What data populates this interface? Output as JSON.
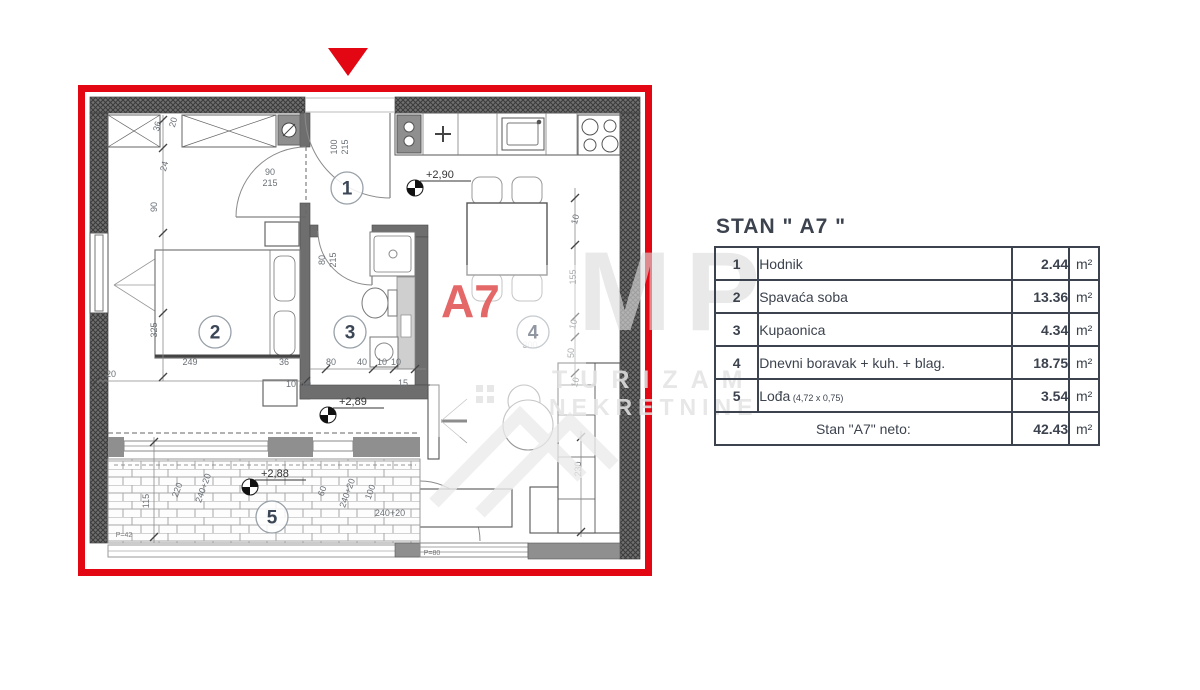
{
  "colors": {
    "accent_red": "#e30613",
    "wall_dark": "#6f6f6f",
    "text_dark": "#3c434e",
    "a7_red": "#e25c5c",
    "watermark": "#e3e3e3"
  },
  "watermark": {
    "letters": "MP",
    "line1": "TURIZAM",
    "line2": "NEKRETNINE"
  },
  "plan": {
    "a7_label": "A7",
    "room_numbers": [
      {
        "n": "1",
        "x": 269,
        "y": 103
      },
      {
        "n": "2",
        "x": 137,
        "y": 247
      },
      {
        "n": "3",
        "x": 272,
        "y": 247
      },
      {
        "n": "4",
        "x": 455,
        "y": 247
      },
      {
        "n": "5",
        "x": 194,
        "y": 432
      }
    ],
    "elevations": [
      {
        "t": "+2,90",
        "x": 337,
        "y": 103
      },
      {
        "t": "+2,89",
        "x": 250,
        "y": 330
      },
      {
        "t": "+2,88",
        "x": 172,
        "y": 402
      }
    ],
    "dim_labels": [
      {
        "t": "36",
        "x": 82,
        "y": 42,
        "r": -75
      },
      {
        "t": "20",
        "x": 98,
        "y": 38,
        "r": -75
      },
      {
        "t": "24",
        "x": 89,
        "y": 82,
        "r": -75
      },
      {
        "t": "90",
        "x": 79,
        "y": 122,
        "r": -90
      },
      {
        "t": "325",
        "x": 79,
        "y": 245,
        "r": -90
      },
      {
        "t": "100",
        "x": 259,
        "y": 62,
        "r": -90
      },
      {
        "t": "215",
        "x": 270,
        "y": 62,
        "r": -90
      },
      {
        "t": "90",
        "x": 192,
        "y": 90,
        "r": 0
      },
      {
        "t": "215",
        "x": 192,
        "y": 101,
        "r": 0
      },
      {
        "t": "80",
        "x": 247,
        "y": 175,
        "r": -90
      },
      {
        "t": "215",
        "x": 258,
        "y": 175,
        "r": -90
      },
      {
        "t": "249",
        "x": 112,
        "y": 280,
        "r": 0
      },
      {
        "t": "36",
        "x": 206,
        "y": 280,
        "r": 0
      },
      {
        "t": "20",
        "x": 33,
        "y": 292,
        "r": 0
      },
      {
        "t": "10",
        "x": 213,
        "y": 302,
        "r": 0
      },
      {
        "t": "10",
        "x": 228,
        "y": 302,
        "r": 0
      },
      {
        "t": "80",
        "x": 253,
        "y": 280,
        "r": 0
      },
      {
        "t": "40",
        "x": 284,
        "y": 280,
        "r": 0
      },
      {
        "t": "10",
        "x": 304,
        "y": 280,
        "r": 0
      },
      {
        "t": "10",
        "x": 318,
        "y": 280,
        "r": 0
      },
      {
        "t": "15",
        "x": 325,
        "y": 301,
        "r": 0
      },
      {
        "t": "10",
        "x": 500,
        "y": 135,
        "r": -75
      },
      {
        "t": "155",
        "x": 498,
        "y": 192,
        "r": -90
      },
      {
        "t": "10",
        "x": 498,
        "y": 240,
        "r": -75
      },
      {
        "t": "50",
        "x": 496,
        "y": 268,
        "r": -90
      },
      {
        "t": "300",
        "x": 452,
        "y": 263,
        "r": 0
      },
      {
        "t": "10",
        "x": 500,
        "y": 298,
        "r": -75
      },
      {
        "t": "230",
        "x": 503,
        "y": 384,
        "r": -90
      },
      {
        "t": "115",
        "x": 71,
        "y": 416,
        "r": -90
      },
      {
        "t": "220",
        "x": 102,
        "y": 406,
        "r": -70
      },
      {
        "t": "240+20",
        "x": 128,
        "y": 404,
        "r": -70
      },
      {
        "t": "60",
        "x": 247,
        "y": 407,
        "r": -70
      },
      {
        "t": "240+20",
        "x": 272,
        "y": 409,
        "r": -70
      },
      {
        "t": "100",
        "x": 295,
        "y": 408,
        "r": -70
      },
      {
        "t": "240+20",
        "x": 312,
        "y": 431,
        "r": 0
      }
    ],
    "area_labels": [
      {
        "t": "P=42",
        "x": 46,
        "y": 452
      },
      {
        "t": "P=80",
        "x": 354,
        "y": 470
      }
    ],
    "lines": [
      [
        85,
        30,
        85,
        296
      ],
      [
        18,
        296,
        230,
        296
      ],
      [
        232,
        284,
        348,
        284
      ],
      [
        497,
        103,
        497,
        300
      ],
      [
        503,
        346,
        503,
        452
      ],
      [
        76,
        352,
        76,
        458
      ]
    ],
    "ticks": [
      [
        85,
        35
      ],
      [
        85,
        63
      ],
      [
        85,
        148
      ],
      [
        85,
        228
      ],
      [
        85,
        292
      ],
      [
        18,
        296
      ],
      [
        228,
        296
      ],
      [
        248,
        284
      ],
      [
        295,
        284
      ],
      [
        316,
        284
      ],
      [
        337,
        284
      ],
      [
        497,
        113
      ],
      [
        497,
        160
      ],
      [
        497,
        232
      ],
      [
        497,
        252
      ],
      [
        497,
        288
      ],
      [
        76,
        357
      ],
      [
        76,
        452
      ],
      [
        503,
        352
      ],
      [
        503,
        447
      ]
    ]
  },
  "table": {
    "title": "STAN  \" A7 \"",
    "rows": [
      {
        "num": "1",
        "name": "Hodnik",
        "note": "",
        "value": "2.44",
        "unit": "m²"
      },
      {
        "num": "2",
        "name": "Spavaća soba",
        "note": "",
        "value": "13.36",
        "unit": "m²"
      },
      {
        "num": "3",
        "name": "Kupaonica",
        "note": "",
        "value": "4.34",
        "unit": "m²"
      },
      {
        "num": "4",
        "name": "Dnevni boravak + kuh. + blag.",
        "note": "",
        "value": "18.75",
        "unit": "m²"
      },
      {
        "num": "5",
        "name": "Lođa",
        "note": "(4,72 x 0,75)",
        "value": "3.54",
        "unit": "m²"
      }
    ],
    "total": {
      "label": "Stan \"A7\" neto:",
      "value": "42.43",
      "unit": "m²"
    }
  }
}
